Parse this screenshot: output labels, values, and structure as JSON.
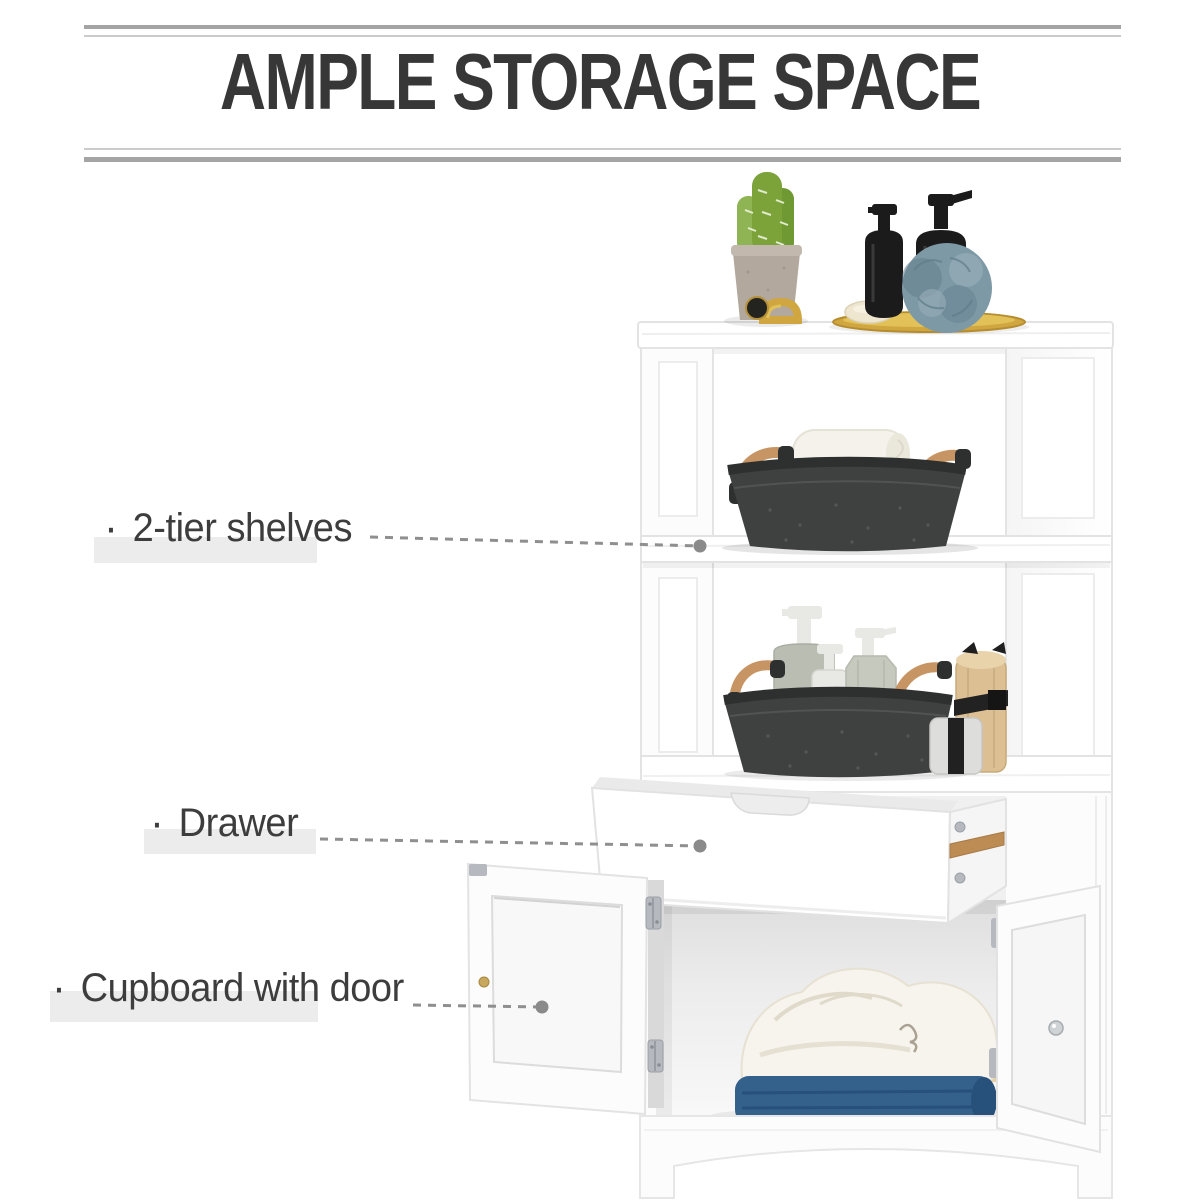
{
  "title": {
    "text": "AMPLE STORAGE SPACE"
  },
  "callouts": {
    "shelves": {
      "bullet": "·",
      "label": "2-tier shelves"
    },
    "drawer": {
      "bullet": "·",
      "label": "Drawer"
    },
    "cupboard": {
      "bullet": "·",
      "label": "Cupboard with door"
    }
  },
  "product": {
    "parts": [
      "cabinet-top-board",
      "two-tier-open-shelves",
      "felt-basket-with-towel",
      "felt-basket-with-toiletries",
      "open-drawer",
      "cupboard-with-open-doors",
      "folded-bathrobe",
      "blue-towel",
      "arched-base"
    ],
    "decor": [
      "cactus-plant",
      "concrete-pot",
      "gold-bracelet",
      "black-pump-bottles",
      "blue-loofah",
      "soap-bar",
      "gold-tray",
      "bamboo-roll"
    ]
  },
  "palette": {
    "c_title": "#373737",
    "c_rule_dark": "#a4a4a4",
    "c_rule_light": "#cbcbcb",
    "c_label": "#3d3d3d",
    "c_label_shadow": "#ececec",
    "c_leader": "#8f8f8f",
    "c_leader_dot": "#8a8a8a",
    "c_white": "#ffffff",
    "c_panel": "#fcfcfc",
    "c_line": "#e3e3e3",
    "c_line_soft": "#ececec",
    "c_interior_dark": "#e2e2e2",
    "c_interior_light": "#f7f7f7",
    "c_basket": "#3f4140",
    "c_basket_rim": "#2e302f",
    "c_basket_fleck": "#6a6c6b",
    "c_wood": "#c79564",
    "c_rail": "#bd8c55",
    "c_gold": "#cfa63f",
    "c_gold_bright": "#e2c258",
    "c_loofah": "#7e99a6",
    "c_loofah_dark": "#64808d",
    "c_towel_blue": "#33618c",
    "c_towel_blue_dark": "#27507a",
    "c_cactus": "#7ba33a",
    "c_cactus_light": "#8fb454",
    "c_pot": "#b3a89e",
    "c_pot_rim": "#c2b8ae",
    "c_bamboo": "#dcbf92",
    "c_bamboo_light": "#e9d3ab",
    "c_robe": "#f7f4ed",
    "c_robe_shade": "#e0dacb",
    "c_cream_towel": "#e5cfa4",
    "c_bottle_black": "#1b1b1b",
    "c_sage": "#b9bdb2",
    "c_bottle_gray": "#c6c9bd",
    "c_bottle_white": "#e8e8e4",
    "c_metal": "#b6bac0",
    "c_metal_dark": "#9aa0a6",
    "c_knob_silver": "#d0d3d6",
    "c_brass": "#c7a85c",
    "c_soap": "#efe6d0",
    "c_towel_white": "#f4f2ea"
  }
}
